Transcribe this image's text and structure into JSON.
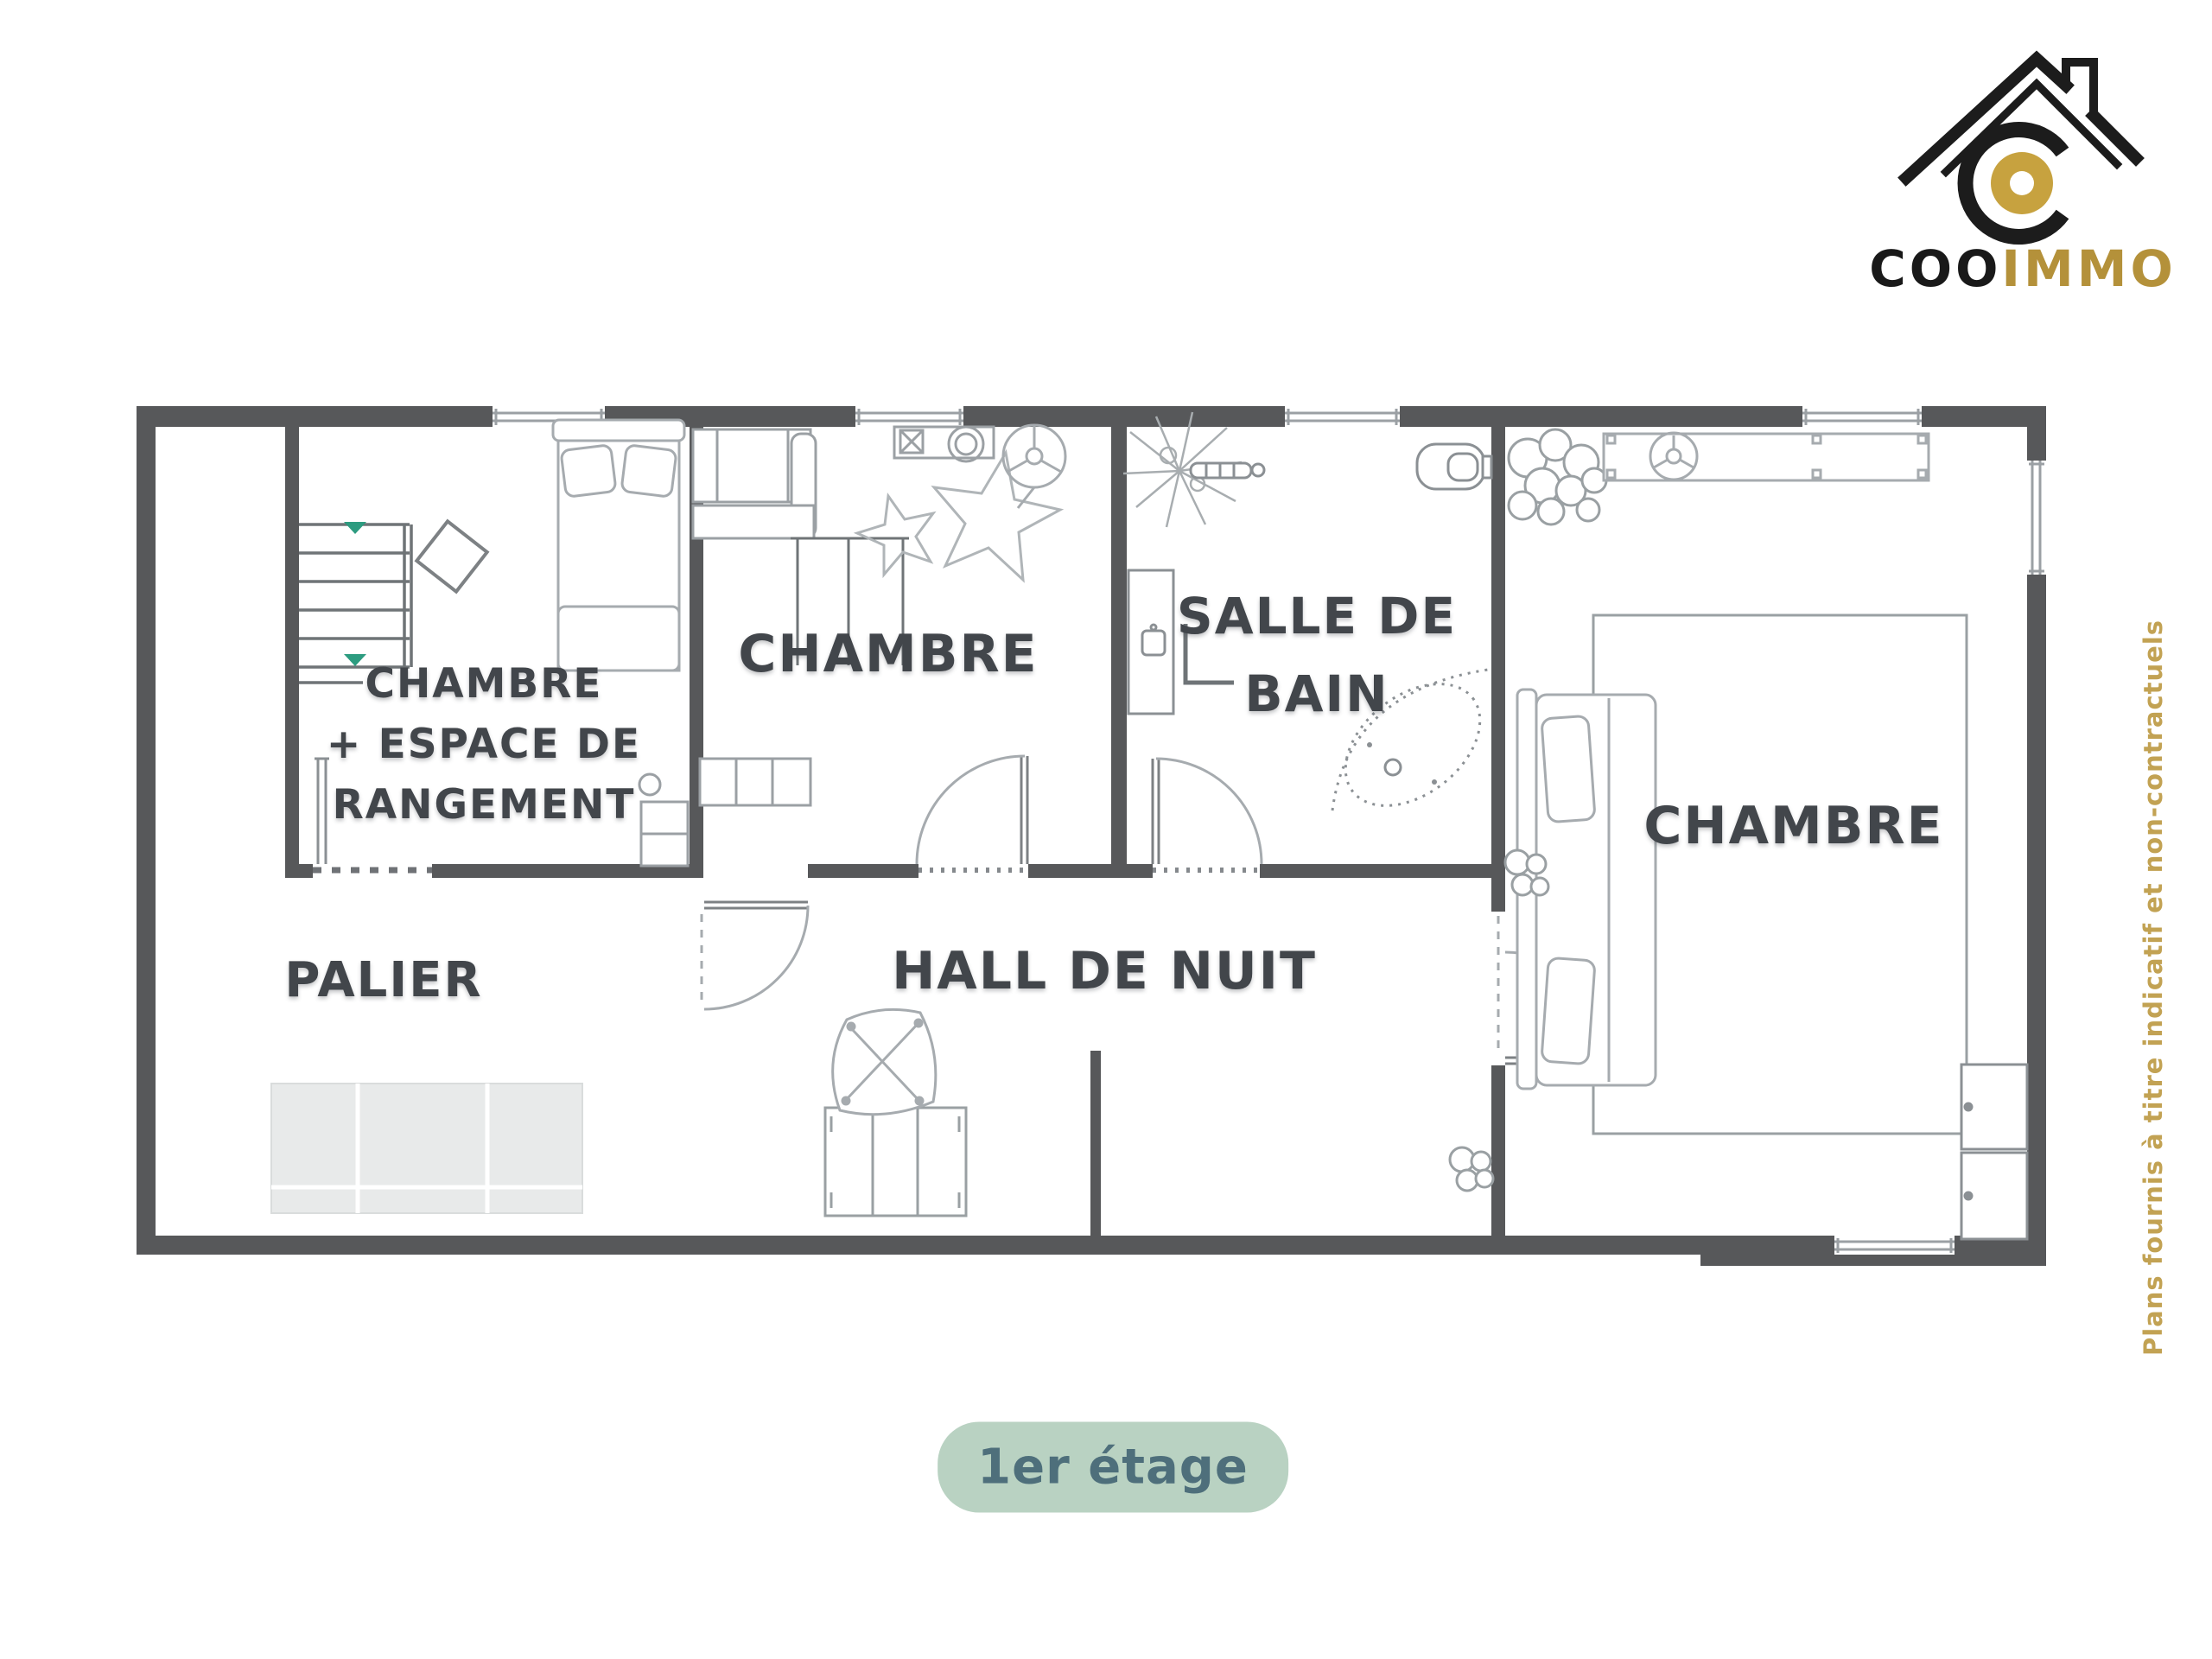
{
  "logo": {
    "brand_black": "COO",
    "brand_gold": "IMMO"
  },
  "floor_plan": {
    "rooms": [
      {
        "id": "storage_bedroom",
        "label": "CHAMBRE\n+ ESPACE DE\nRANGEMENT"
      },
      {
        "id": "bedroom_center",
        "label": "CHAMBRE"
      },
      {
        "id": "bathroom",
        "label": "SALLE DE\nBAIN"
      },
      {
        "id": "bedroom_right",
        "label": "CHAMBRE"
      },
      {
        "id": "landing",
        "label": "PALIER"
      },
      {
        "id": "night_hall",
        "label": "HALL DE NUIT"
      }
    ]
  },
  "floor_badge": {
    "label": "1er étage"
  },
  "disclaimer": {
    "text": "Plans fournis à titre indicatif et non-contractuels"
  },
  "colors": {
    "wall": "#57585a",
    "furniture_line": "#9ba0a4",
    "label_text": "#42464b",
    "accent_gold": "#c2a253",
    "logo_gold": "#c7a23f",
    "badge_bg": "#b9d2c2",
    "badge_text": "#4e6f7b",
    "stair_arrow": "#2d9c80"
  }
}
